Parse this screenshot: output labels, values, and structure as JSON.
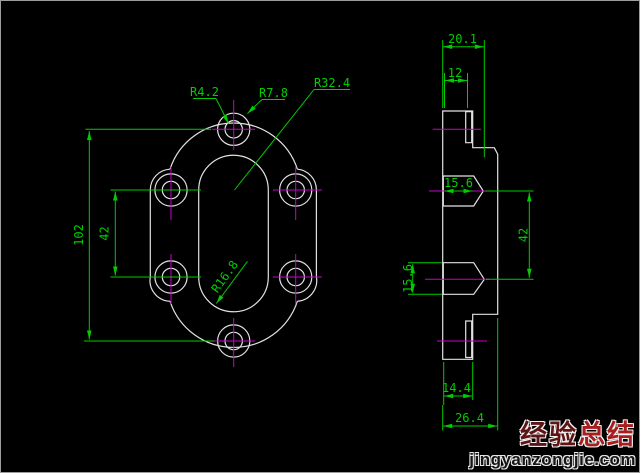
{
  "front_view": {
    "radius_hole": "R4.2",
    "radius_boss": "R7.8",
    "radius_outline": "R32.4",
    "radius_slot": "R16.8",
    "dim_height": "102",
    "dim_hole_spacing": "42"
  },
  "side_view": {
    "dim_total_width": "20.1",
    "dim_plate_width": "12",
    "dim_cbore_depth": "15.6",
    "dim_cbore_dia": "15.6",
    "dim_hole_spacing": "42",
    "dim_boss_width": "14.4",
    "dim_hub_width": "26.4"
  },
  "watermark": {
    "brand_part1": "经验",
    "brand_part2": "总结",
    "site": "jingyanzongjie.com"
  },
  "colors": {
    "background": "#000000",
    "outline": "#e2e2e2",
    "dimension": "#00cc00",
    "centerline": "#cc00cc",
    "hatch": "#00b8b8",
    "brand_red": "#a81e1e"
  }
}
